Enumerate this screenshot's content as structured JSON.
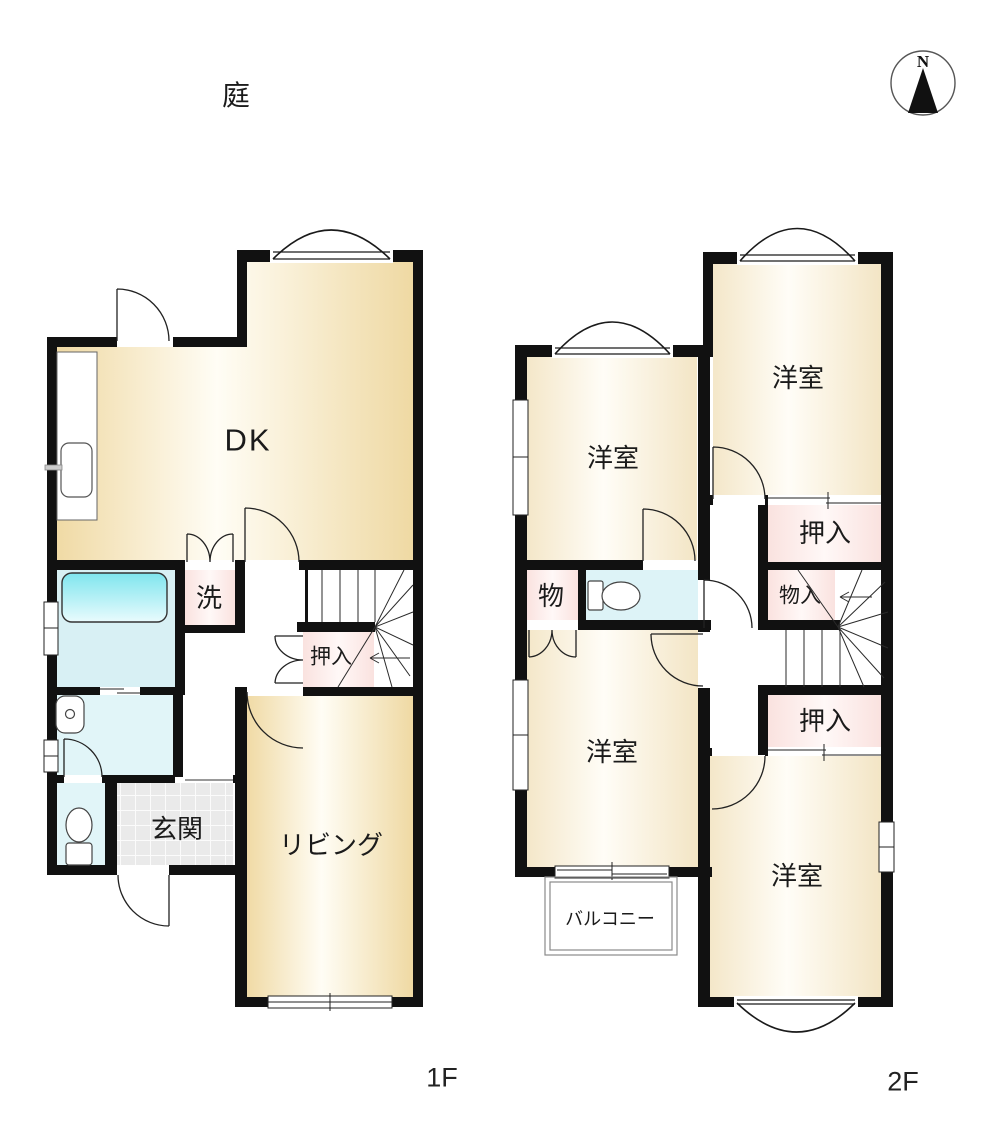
{
  "compass": {
    "north_letter": "N"
  },
  "site": {
    "garden": "庭"
  },
  "floor1": {
    "floor_label": "1F",
    "dk": "DK",
    "living": "リビング",
    "entrance": "玄関",
    "laundry": "洗",
    "closet": "押入"
  },
  "floor2": {
    "floor_label": "2F",
    "room_top_left": "洋室",
    "room_top_right": "洋室",
    "room_bottom_left": "洋室",
    "room_bottom_right": "洋室",
    "closet_top": "押入",
    "storage_small": "物",
    "storage": "物入",
    "closet_bottom": "押入",
    "balcony": "バルコニー"
  },
  "colors": {
    "wall": "#111111",
    "room_floor_edge": "#f1dcaa",
    "room_floor_light": "#fffdf6",
    "closet_pink": "#fae3e0",
    "bath_cyan": "#7fe5ee",
    "water_floor": "#ddf3f7",
    "tile_grey": "#eaeaea"
  }
}
